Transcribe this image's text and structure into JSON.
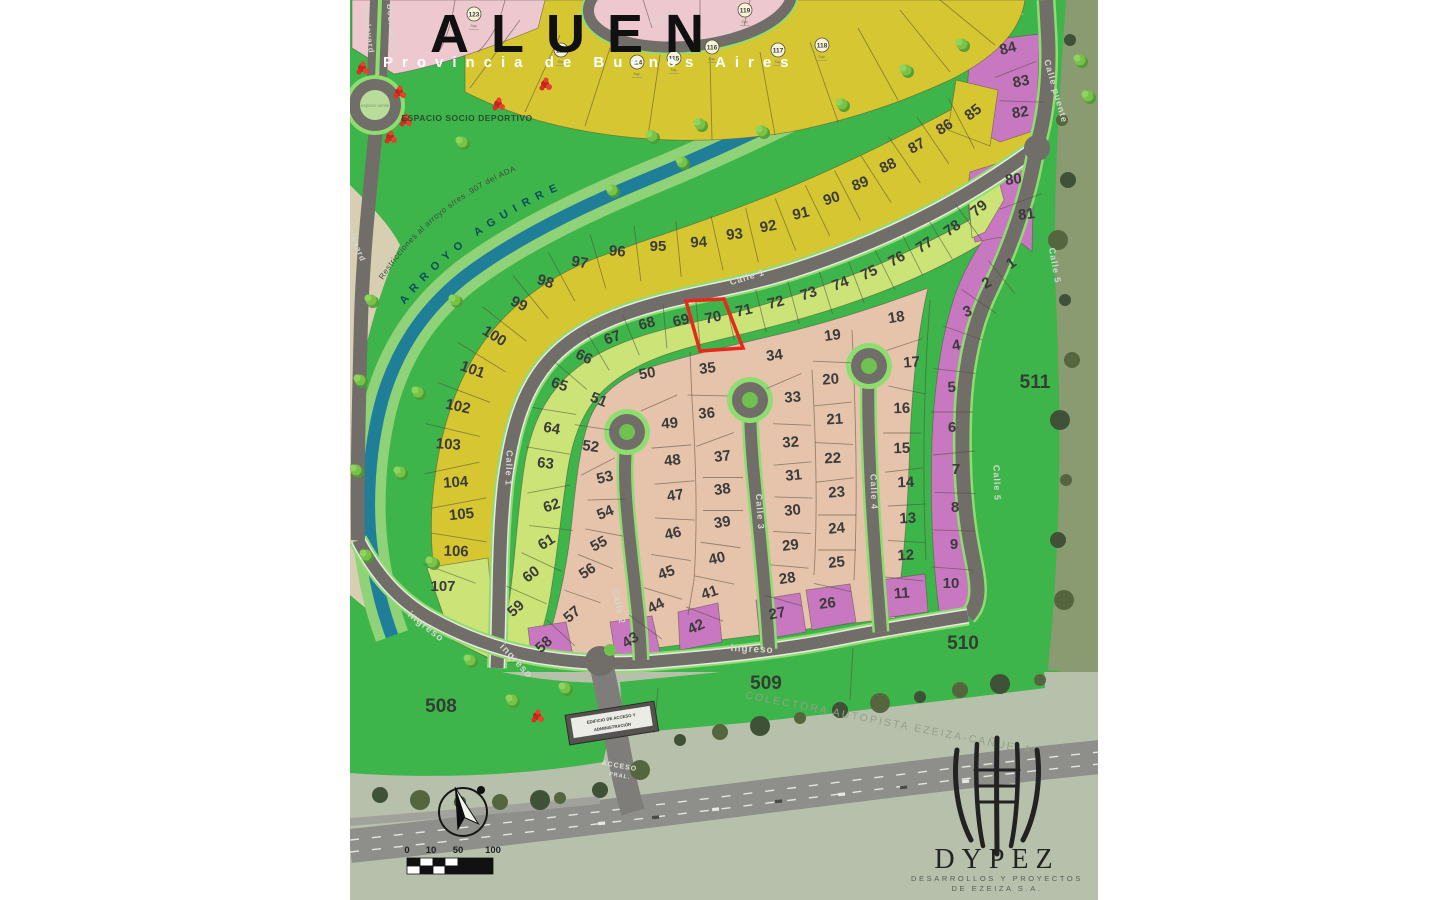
{
  "title": {
    "name": "ALUEN",
    "subtitle": "Provincia de Buenos Aires"
  },
  "logo": {
    "brand": "DYPEZ",
    "line1": "DESARROLLOS Y PROYECTOS",
    "line2": "DE EZEIZA S.A."
  },
  "labels": {
    "espacio_deportivo": "ESPACIO SOCIO DEPORTIVO",
    "espacio_verde": "espacio verde",
    "arroyo": "ARROYO AGUIRRE",
    "restricciones": "Restricciones al arroyo s/res .907 del ADA",
    "colectora": "COLECTORA AUTOPISTA EZEIZA-CAÑUELAS",
    "edificio_line1": "EDIFICIO DE ACCESO Y",
    "edificio_line2": "ADMINISTRACIÓN",
    "acceso_line1": "ACCESO",
    "acceso_line2": "PRAL.",
    "sup": "Sup."
  },
  "scalebar": {
    "ticks": [
      "0",
      "10",
      "50",
      "100"
    ]
  },
  "colors": {
    "bg_green": "#3db54a",
    "lot_yellow": "#d6c632",
    "lot_green": "#cbe377",
    "lot_tan": "#e6c4ac",
    "lot_purple": "#c878c0",
    "lot_pink": "#edc9cf",
    "stream": "#1f7f99",
    "bank": "#8fd277",
    "beige": "#d8cfb2",
    "road": "#716d69",
    "road_verge": "#8edd6f",
    "highlight": "#e8281d",
    "satellite": "#b7c0ab",
    "olive": "#8a9b72",
    "number": "#3b3b3b",
    "road_label": "#d8d6d0"
  },
  "green_areas": [
    {
      "n": "508",
      "x": 441,
      "y": 712
    },
    {
      "n": "509",
      "x": 766,
      "y": 689
    },
    {
      "n": "510",
      "x": 963,
      "y": 649
    },
    {
      "n": "511",
      "x": 1035,
      "y": 388
    }
  ],
  "circled_lots": [
    {
      "n": "123",
      "x": 474,
      "y": 14
    },
    {
      "n": "113",
      "x": 561,
      "y": 50
    },
    {
      "n": "114",
      "x": 637,
      "y": 62
    },
    {
      "n": "115",
      "x": 674,
      "y": 58
    },
    {
      "n": "116",
      "x": 712,
      "y": 47
    },
    {
      "n": "117",
      "x": 778,
      "y": 50
    },
    {
      "n": "118",
      "x": 822,
      "y": 45
    },
    {
      "n": "119",
      "x": 745,
      "y": 10
    }
  ],
  "streets": [
    {
      "t": "Calle 1",
      "x": 748,
      "y": 280,
      "r": -17,
      "s": 9
    },
    {
      "t": "Calle 1",
      "x": 506,
      "y": 468,
      "r": 92,
      "s": 9
    },
    {
      "t": "Calle 2",
      "x": 616,
      "y": 607,
      "r": 78,
      "s": 9
    },
    {
      "t": "Calle 3",
      "x": 757,
      "y": 512,
      "r": 86,
      "s": 9
    },
    {
      "t": "Calle 4",
      "x": 871,
      "y": 492,
      "r": 88,
      "s": 9
    },
    {
      "t": "Calle 5",
      "x": 994,
      "y": 483,
      "r": 88,
      "s": 9
    },
    {
      "t": "Calle 5",
      "x": 1052,
      "y": 266,
      "r": 80,
      "s": 9
    },
    {
      "t": "Calle puente",
      "x": 1053,
      "y": 92,
      "r": 74,
      "s": 9
    },
    {
      "t": "Calle",
      "x": 662,
      "y": 22,
      "r": -10,
      "s": 8
    },
    {
      "t": "ingreso",
      "x": 424,
      "y": 629,
      "r": 38,
      "s": 10
    },
    {
      "t": "ingreso",
      "x": 514,
      "y": 663,
      "r": 47,
      "s": 10
    },
    {
      "t": "ingreso",
      "x": 752,
      "y": 652,
      "r": 3,
      "s": 10
    },
    {
      "t": "Boulevard",
      "x": 366,
      "y": 30,
      "r": 83,
      "s": 8
    },
    {
      "t": "Boulevard",
      "x": 389,
      "y": 28,
      "r": 85,
      "s": 8
    },
    {
      "t": "Boulevard",
      "x": 352,
      "y": 240,
      "r": 68,
      "s": 8
    }
  ],
  "lots": [
    {
      "n": "85",
      "x": 976,
      "y": 116,
      "r": -38,
      "c": "y"
    },
    {
      "n": "86",
      "x": 947,
      "y": 131,
      "r": -33,
      "c": "y"
    },
    {
      "n": "87",
      "x": 919,
      "y": 150,
      "r": -30,
      "c": "y"
    },
    {
      "n": "88",
      "x": 890,
      "y": 170,
      "r": -26,
      "c": "y"
    },
    {
      "n": "89",
      "x": 862,
      "y": 188,
      "r": -22,
      "c": "y"
    },
    {
      "n": "90",
      "x": 833,
      "y": 203,
      "r": -18,
      "c": "y"
    },
    {
      "n": "91",
      "x": 802,
      "y": 218,
      "r": -14,
      "c": "y"
    },
    {
      "n": "92",
      "x": 769,
      "y": 231,
      "r": -10,
      "c": "y"
    },
    {
      "n": "93",
      "x": 735,
      "y": 239,
      "r": -6,
      "c": "y"
    },
    {
      "n": "94",
      "x": 699,
      "y": 247,
      "r": -3,
      "c": "y"
    },
    {
      "n": "95",
      "x": 658,
      "y": 251,
      "r": 0,
      "c": "y"
    },
    {
      "n": "96",
      "x": 617,
      "y": 256,
      "r": 4,
      "c": "y"
    },
    {
      "n": "97",
      "x": 579,
      "y": 267,
      "r": 10,
      "c": "y"
    },
    {
      "n": "98",
      "x": 544,
      "y": 286,
      "r": 18,
      "c": "y"
    },
    {
      "n": "99",
      "x": 517,
      "y": 308,
      "r": 26,
      "c": "y"
    },
    {
      "n": "100",
      "x": 492,
      "y": 340,
      "r": 32,
      "c": "y"
    },
    {
      "n": "101",
      "x": 471,
      "y": 374,
      "r": 20,
      "c": "y"
    },
    {
      "n": "102",
      "x": 457,
      "y": 411,
      "r": 12,
      "c": "y"
    },
    {
      "n": "103",
      "x": 448,
      "y": 449,
      "r": 4,
      "c": "y"
    },
    {
      "n": "104",
      "x": 456,
      "y": 487,
      "r": -4,
      "c": "y"
    },
    {
      "n": "105",
      "x": 462,
      "y": 519,
      "r": -6,
      "c": "y"
    },
    {
      "n": "106",
      "x": 456,
      "y": 556,
      "r": 2,
      "c": "y"
    },
    {
      "n": "107",
      "x": 443,
      "y": 591,
      "r": 0,
      "c": "g"
    },
    {
      "n": "59",
      "x": 519,
      "y": 612,
      "r": -42,
      "c": "g"
    },
    {
      "n": "60",
      "x": 534,
      "y": 578,
      "r": -38,
      "c": "g"
    },
    {
      "n": "61",
      "x": 549,
      "y": 546,
      "r": -32,
      "c": "g"
    },
    {
      "n": "62",
      "x": 553,
      "y": 510,
      "r": -18,
      "c": "g"
    },
    {
      "n": "63",
      "x": 545,
      "y": 468,
      "r": 6,
      "c": "g"
    },
    {
      "n": "64",
      "x": 551,
      "y": 433,
      "r": 10,
      "c": "g"
    },
    {
      "n": "65",
      "x": 558,
      "y": 389,
      "r": 18,
      "c": "g"
    },
    {
      "n": "66",
      "x": 582,
      "y": 361,
      "r": 26,
      "c": "g"
    },
    {
      "n": "67",
      "x": 614,
      "y": 342,
      "r": -20,
      "c": "g"
    },
    {
      "n": "68",
      "x": 648,
      "y": 328,
      "r": -15,
      "c": "g"
    },
    {
      "n": "69",
      "x": 682,
      "y": 325,
      "r": -12,
      "c": "g"
    },
    {
      "n": "70",
      "x": 714,
      "y": 322,
      "r": -12,
      "c": "g",
      "hl": true
    },
    {
      "n": "71",
      "x": 745,
      "y": 315,
      "r": -13,
      "c": "g"
    },
    {
      "n": "72",
      "x": 777,
      "y": 307,
      "r": -15,
      "c": "g"
    },
    {
      "n": "73",
      "x": 810,
      "y": 298,
      "r": -18,
      "c": "g"
    },
    {
      "n": "74",
      "x": 842,
      "y": 288,
      "r": -21,
      "c": "g"
    },
    {
      "n": "75",
      "x": 871,
      "y": 277,
      "r": -25,
      "c": "g"
    },
    {
      "n": "76",
      "x": 899,
      "y": 263,
      "r": -29,
      "c": "g"
    },
    {
      "n": "77",
      "x": 927,
      "y": 249,
      "r": -33,
      "c": "g"
    },
    {
      "n": "78",
      "x": 955,
      "y": 232,
      "r": -36,
      "c": "g"
    },
    {
      "n": "79",
      "x": 982,
      "y": 212,
      "r": -40,
      "c": "g"
    },
    {
      "n": "51",
      "x": 597,
      "y": 404,
      "r": 22,
      "c": "t"
    },
    {
      "n": "52",
      "x": 590,
      "y": 451,
      "r": 8,
      "c": "t"
    },
    {
      "n": "53",
      "x": 606,
      "y": 482,
      "r": -14,
      "c": "t"
    },
    {
      "n": "54",
      "x": 607,
      "y": 517,
      "r": -22,
      "c": "t"
    },
    {
      "n": "55",
      "x": 601,
      "y": 548,
      "r": -28,
      "c": "t"
    },
    {
      "n": "56",
      "x": 590,
      "y": 575,
      "r": -34,
      "c": "t"
    },
    {
      "n": "57",
      "x": 575,
      "y": 618,
      "r": -40,
      "c": "t"
    },
    {
      "n": "58",
      "x": 547,
      "y": 648,
      "r": -42,
      "c": "p"
    },
    {
      "n": "50",
      "x": 648,
      "y": 378,
      "r": -10,
      "c": "t"
    },
    {
      "n": "49",
      "x": 670,
      "y": 428,
      "r": -4,
      "c": "t"
    },
    {
      "n": "48",
      "x": 673,
      "y": 465,
      "r": -7,
      "c": "t"
    },
    {
      "n": "47",
      "x": 676,
      "y": 500,
      "r": -9,
      "c": "t"
    },
    {
      "n": "46",
      "x": 674,
      "y": 538,
      "r": -13,
      "c": "t"
    },
    {
      "n": "45",
      "x": 668,
      "y": 577,
      "r": -20,
      "c": "t"
    },
    {
      "n": "44",
      "x": 658,
      "y": 610,
      "r": -27,
      "c": "t"
    },
    {
      "n": "43",
      "x": 633,
      "y": 644,
      "r": -33,
      "c": "p"
    },
    {
      "n": "35",
      "x": 708,
      "y": 373,
      "r": -7,
      "c": "t"
    },
    {
      "n": "36",
      "x": 707,
      "y": 418,
      "r": -4,
      "c": "t"
    },
    {
      "n": "37",
      "x": 723,
      "y": 461,
      "r": -7,
      "c": "t"
    },
    {
      "n": "38",
      "x": 723,
      "y": 494,
      "r": -8,
      "c": "t"
    },
    {
      "n": "39",
      "x": 723,
      "y": 527,
      "r": -9,
      "c": "t"
    },
    {
      "n": "40",
      "x": 718,
      "y": 563,
      "r": -13,
      "c": "t"
    },
    {
      "n": "41",
      "x": 711,
      "y": 597,
      "r": -18,
      "c": "t"
    },
    {
      "n": "42",
      "x": 698,
      "y": 631,
      "r": -25,
      "c": "p"
    },
    {
      "n": "34",
      "x": 775,
      "y": 360,
      "r": -7,
      "c": "t"
    },
    {
      "n": "33",
      "x": 793,
      "y": 402,
      "r": -4,
      "c": "t"
    },
    {
      "n": "32",
      "x": 791,
      "y": 447,
      "r": -4,
      "c": "t"
    },
    {
      "n": "31",
      "x": 794,
      "y": 480,
      "r": -5,
      "c": "t"
    },
    {
      "n": "30",
      "x": 793,
      "y": 515,
      "r": -6,
      "c": "t"
    },
    {
      "n": "29",
      "x": 791,
      "y": 550,
      "r": -7,
      "c": "t"
    },
    {
      "n": "28",
      "x": 788,
      "y": 583,
      "r": -9,
      "c": "t"
    },
    {
      "n": "27",
      "x": 778,
      "y": 618,
      "r": -11,
      "c": "p"
    },
    {
      "n": "19",
      "x": 833,
      "y": 340,
      "r": -7,
      "c": "t"
    },
    {
      "n": "20",
      "x": 831,
      "y": 384,
      "r": -4,
      "c": "t"
    },
    {
      "n": "21",
      "x": 835,
      "y": 424,
      "r": -3,
      "c": "t"
    },
    {
      "n": "22",
      "x": 833,
      "y": 463,
      "r": -3,
      "c": "t"
    },
    {
      "n": "23",
      "x": 837,
      "y": 497,
      "r": -4,
      "c": "t"
    },
    {
      "n": "24",
      "x": 837,
      "y": 533,
      "r": -5,
      "c": "t"
    },
    {
      "n": "25",
      "x": 837,
      "y": 567,
      "r": -6,
      "c": "t"
    },
    {
      "n": "26",
      "x": 828,
      "y": 608,
      "r": -7,
      "c": "p"
    },
    {
      "n": "18",
      "x": 897,
      "y": 322,
      "r": -9,
      "c": "t"
    },
    {
      "n": "17",
      "x": 912,
      "y": 367,
      "r": -4,
      "c": "t"
    },
    {
      "n": "16",
      "x": 902,
      "y": 413,
      "r": -2,
      "c": "t"
    },
    {
      "n": "15",
      "x": 902,
      "y": 453,
      "r": -2,
      "c": "t"
    },
    {
      "n": "14",
      "x": 906,
      "y": 487,
      "r": -2,
      "c": "t"
    },
    {
      "n": "13",
      "x": 908,
      "y": 523,
      "r": -3,
      "c": "t"
    },
    {
      "n": "12",
      "x": 906,
      "y": 560,
      "r": -3,
      "c": "t"
    },
    {
      "n": "11",
      "x": 902,
      "y": 598,
      "r": -4,
      "c": "p"
    },
    {
      "n": "1",
      "x": 1014,
      "y": 267,
      "r": -36,
      "c": "p"
    },
    {
      "n": "2",
      "x": 989,
      "y": 287,
      "r": -30,
      "c": "p"
    },
    {
      "n": "3",
      "x": 969,
      "y": 316,
      "r": -20,
      "c": "p"
    },
    {
      "n": "4",
      "x": 957,
      "y": 350,
      "r": -10,
      "c": "p"
    },
    {
      "n": "5",
      "x": 952,
      "y": 392,
      "r": -4,
      "c": "p"
    },
    {
      "n": "6",
      "x": 952,
      "y": 432,
      "r": 0,
      "c": "p"
    },
    {
      "n": "7",
      "x": 956,
      "y": 474,
      "r": 0,
      "c": "p"
    },
    {
      "n": "8",
      "x": 955,
      "y": 512,
      "r": 0,
      "c": "p"
    },
    {
      "n": "9",
      "x": 954,
      "y": 549,
      "r": 0,
      "c": "p"
    },
    {
      "n": "10",
      "x": 951,
      "y": 588,
      "r": 0,
      "c": "p"
    },
    {
      "n": "84",
      "x": 1009,
      "y": 53,
      "r": -14,
      "c": "p"
    },
    {
      "n": "83",
      "x": 1022,
      "y": 86,
      "r": -11,
      "c": "p"
    },
    {
      "n": "82",
      "x": 1021,
      "y": 117,
      "r": -9,
      "c": "p"
    },
    {
      "n": "80",
      "x": 1014,
      "y": 184,
      "r": -7,
      "c": "p"
    },
    {
      "n": "81",
      "x": 1027,
      "y": 219,
      "r": -7,
      "c": "p"
    }
  ],
  "divider_bands": [
    {
      "len": 56,
      "ids": [
        "85",
        "86",
        "87",
        "88",
        "89",
        "90",
        "91",
        "92",
        "93",
        "94",
        "95",
        "96",
        "97",
        "98",
        "99",
        "100",
        "101",
        "102",
        "103",
        "104",
        "105",
        "106",
        "107"
      ]
    },
    {
      "len": 44,
      "ids": [
        "59",
        "60",
        "61",
        "62",
        "63",
        "64",
        "65",
        "66",
        "67",
        "68",
        "69",
        "70",
        "71",
        "72",
        "73",
        "74",
        "75",
        "76",
        "77",
        "78",
        "79"
      ]
    },
    {
      "len": 38,
      "ids": [
        "51",
        "52",
        "53",
        "54",
        "55",
        "56",
        "57",
        "58"
      ]
    },
    {
      "len": 40,
      "ids": [
        "50",
        "49",
        "48",
        "47",
        "46",
        "45",
        "44",
        "43"
      ]
    },
    {
      "len": 40,
      "ids": [
        "35",
        "36",
        "37",
        "38",
        "39",
        "40",
        "41",
        "42"
      ]
    },
    {
      "len": 38,
      "ids": [
        "34",
        "33",
        "32",
        "31",
        "30",
        "29",
        "28",
        "27"
      ]
    },
    {
      "len": 38,
      "ids": [
        "19",
        "20",
        "21",
        "22",
        "23",
        "24",
        "25",
        "26"
      ]
    },
    {
      "len": 38,
      "ids": [
        "18",
        "17",
        "16",
        "15",
        "14",
        "13",
        "12",
        "11"
      ]
    },
    {
      "len": 42,
      "ids": [
        "1",
        "2",
        "3",
        "4",
        "5",
        "6",
        "7",
        "8",
        "9",
        "10"
      ]
    },
    {
      "len": 44,
      "ids": [
        "84",
        "83",
        "82"
      ]
    },
    {
      "len": 44,
      "ids": [
        "80",
        "81"
      ]
    }
  ]
}
